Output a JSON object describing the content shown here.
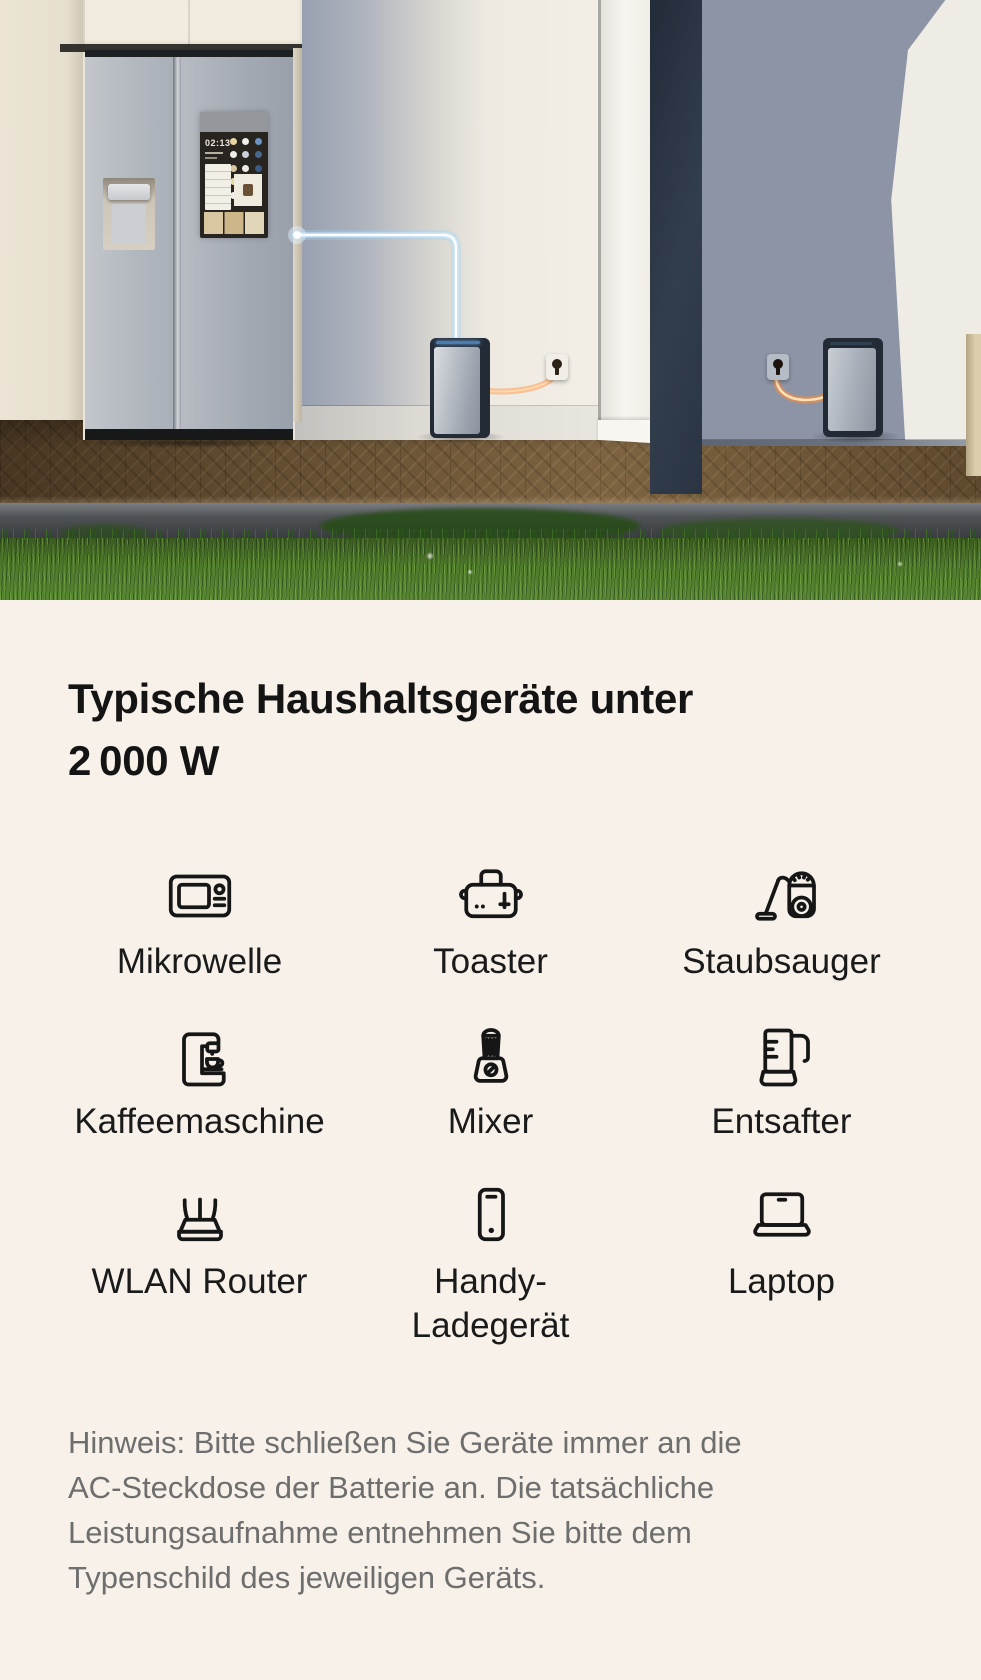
{
  "hero": {
    "screen_clock": "02:13"
  },
  "heading": {
    "lines": [
      "Typische Haushaltsgeräte unter",
      "2 000 W"
    ]
  },
  "appliances": {
    "items": [
      {
        "label": "Mikrowelle",
        "icon": "microwave-icon"
      },
      {
        "label": "Toaster",
        "icon": "toaster-icon"
      },
      {
        "label": "Staubsauger",
        "icon": "vacuum-cleaner-icon"
      },
      {
        "label": "Kaffeemaschine",
        "icon": "coffee-machine-icon"
      },
      {
        "label": "Mixer",
        "icon": "blender-icon"
      },
      {
        "label": "Entsafter",
        "icon": "juicer-icon"
      },
      {
        "label": "WLAN Router",
        "icon": "wifi-router-icon"
      },
      {
        "label": "Handy-Ladegerät",
        "icon": "phone-charger-icon"
      },
      {
        "label": "Laptop",
        "icon": "laptop-icon"
      }
    ]
  },
  "note": {
    "lines": [
      "Hinweis: Bitte schließen Sie Geräte immer an die",
      "AC-Steckdose der Batterie an. Die tatsächliche",
      "Leistungsaufnahme entnehmen Sie bitte dem",
      "Typenschild des jeweiligen Geräts."
    ]
  },
  "colors": {
    "background": "#f7f1ea",
    "heading_text": "#141414",
    "label_text": "#1a1a1a",
    "note_text": "#6e6e6e",
    "glow_blue": "#bfe4ff",
    "glow_orange": "#ff9a4d"
  }
}
